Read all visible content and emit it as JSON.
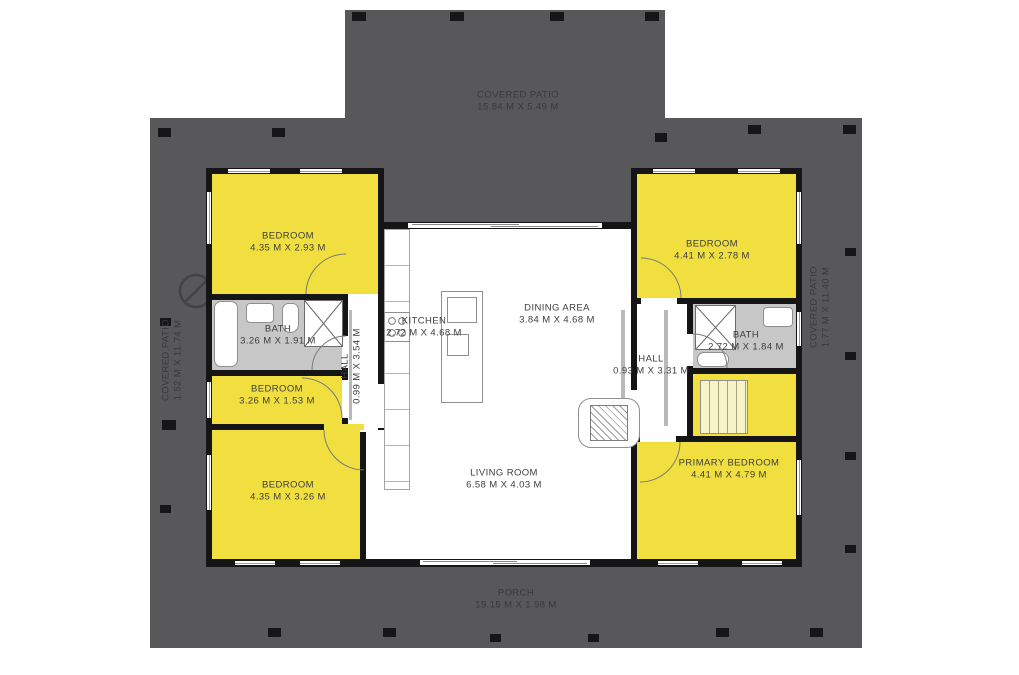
{
  "colors": {
    "room_yellow": "#F0DF3E",
    "patio_gray": "#58585A",
    "bath_gray": "#C7C7C7",
    "wall_black": "#151515",
    "floor_white": "#FFFFFF"
  },
  "rooms": {
    "covered_patio_top": {
      "label": "COVERED PATIO",
      "dims": "15.84 M X 5.49 M"
    },
    "covered_patio_left": {
      "label": "COVERED PATIO",
      "dims": "1.52 M X 11.74 M"
    },
    "covered_patio_right": {
      "label": "COVERED PATIO",
      "dims": "1.77 M X 11.40 M"
    },
    "porch": {
      "label": "PORCH",
      "dims": "19.15 M X 1.98 M"
    },
    "bedroom_top_left": {
      "label": "BEDROOM",
      "dims": "4.35 M X 2.93 M"
    },
    "bedroom_top_right": {
      "label": "BEDROOM",
      "dims": "4.41 M X 2.78 M"
    },
    "bedroom_middle_left": {
      "label": "BEDROOM",
      "dims": "3.26 M X 1.53 M"
    },
    "bedroom_bottom_left": {
      "label": "BEDROOM",
      "dims": "4.35 M X 3.26 M"
    },
    "primary_bedroom": {
      "label": "PRIMARY BEDROOM",
      "dims": "4.41 M X 4.79 M"
    },
    "bath_left": {
      "label": "BATH",
      "dims": "3.26 M X 1.91 M"
    },
    "bath_right": {
      "label": "BATH",
      "dims": "2.72 M X 1.84 M"
    },
    "kitchen": {
      "label": "KITCHEN",
      "dims": "2.72 M X 4.68 M"
    },
    "dining_area": {
      "label": "DINING AREA",
      "dims": "3.84 M X 4.68 M"
    },
    "living_room": {
      "label": "LIVING ROOM",
      "dims": "6.58 M X 4.03 M"
    },
    "hall_left": {
      "label": "HALL",
      "dims": "0.99 M X 3.54 M"
    },
    "hall_right": {
      "label": "HALL",
      "dims": "0.93 M X 3.31 M"
    }
  }
}
